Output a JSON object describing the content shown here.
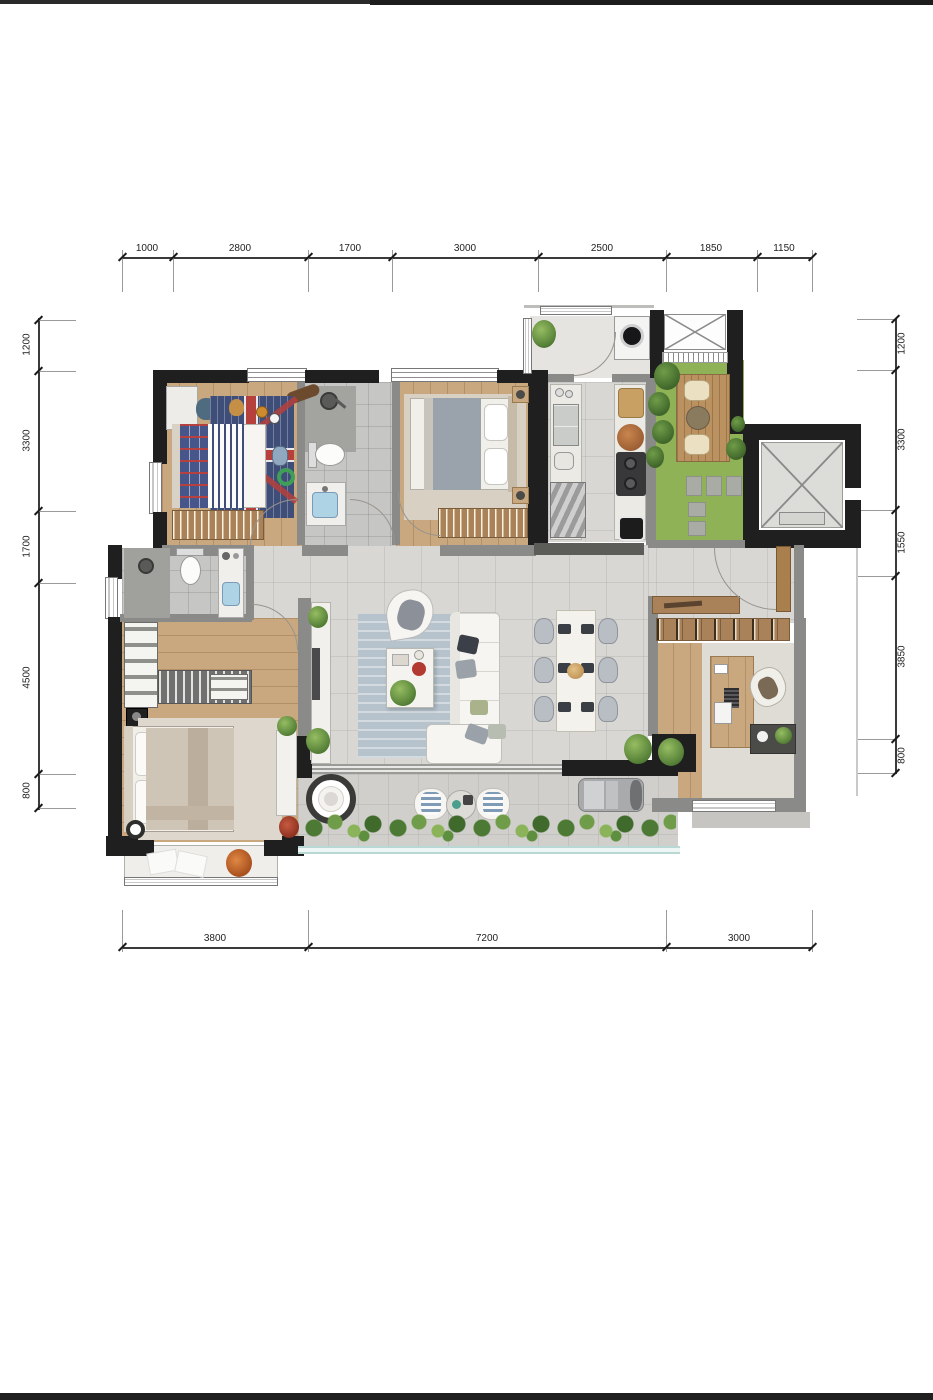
{
  "dims": {
    "top": [
      "1000",
      "2800",
      "1700",
      "3000",
      "2500",
      "1850",
      "1150"
    ],
    "left": [
      "1200",
      "3300",
      "1700",
      "4500",
      "800"
    ],
    "right": [
      "1200",
      "3300",
      "1550",
      "3850",
      "800"
    ],
    "bottom": [
      "3800",
      "7200",
      "3000"
    ]
  },
  "palette": {
    "structural_wall": "#1f1f1f",
    "partition_wall": "#8a8a88",
    "wood_floor": "#c9a87f",
    "marble_floor": "#d8d7d3",
    "bath_tile": "#c6c6c4",
    "grass": "#8fb257",
    "deck_wood": "#bb9160",
    "kids_rug_navy": "#3f4e78",
    "flag_cross_red": "#b5403c",
    "living_rug_blue": "#b6c3cd",
    "balcony_railing": "#b8d8d4"
  },
  "rooms": [
    "kids-bedroom",
    "shared-bathroom",
    "bedroom-2",
    "kitchen",
    "laundry",
    "courtyard",
    "elevator",
    "master-bathroom",
    "master-bedroom",
    "living-room",
    "dining-area",
    "entry-hall",
    "study",
    "balcony"
  ]
}
